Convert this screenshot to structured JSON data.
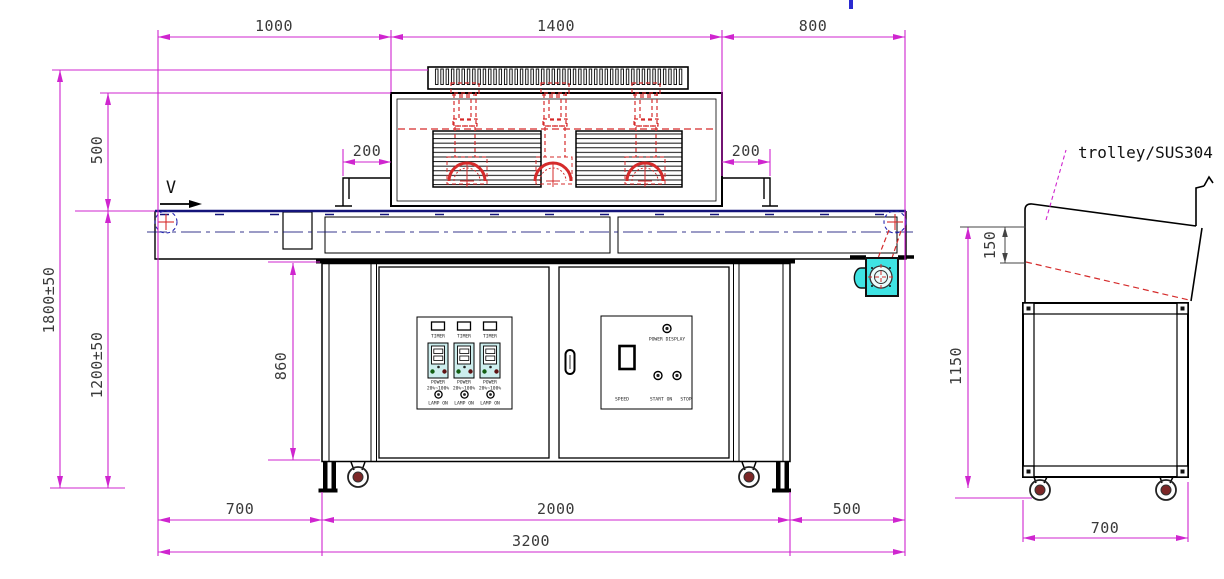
{
  "labels": {
    "velocity": "V",
    "trolley_title": "trolley/SUS304"
  },
  "dims": {
    "top_1000": "1000",
    "top_1400": "1400",
    "top_800": "800",
    "left_1800": "1800±50",
    "left_500": "500",
    "left_1200": "1200±50",
    "offset_left_200": "200",
    "offset_right_200": "200",
    "cabinet_860": "860",
    "bottom_700": "700",
    "bottom_2000": "2000",
    "bottom_500": "500",
    "bottom_3200": "3200",
    "trolley_150": "150",
    "trolley_1150": "1150",
    "trolley_700": "700"
  },
  "control_panel": {
    "modules": [
      {
        "timer": "TIMER",
        "power": "POWER",
        "range": "20%~100%",
        "lamp": "LAMP ON"
      },
      {
        "timer": "TIMER",
        "power": "POWER",
        "range": "20%~100%",
        "lamp": "LAMP ON"
      },
      {
        "timer": "TIMER",
        "power": "POWER",
        "range": "20%~100%",
        "lamp": "LAMP ON"
      }
    ]
  },
  "operator_panel": {
    "power_display": "POWER DISPLAY",
    "speed": "SPEED",
    "start": "START ON",
    "stop": "STOP"
  },
  "colors": {
    "dimension_magenta": "#cf25cf",
    "drawing_black": "#000000",
    "detail_red": "#d52b2b",
    "conveyor_navy": "#14147a",
    "motor_cyan": "#3fe3e3",
    "panel_cyan": "#cdeeee"
  }
}
